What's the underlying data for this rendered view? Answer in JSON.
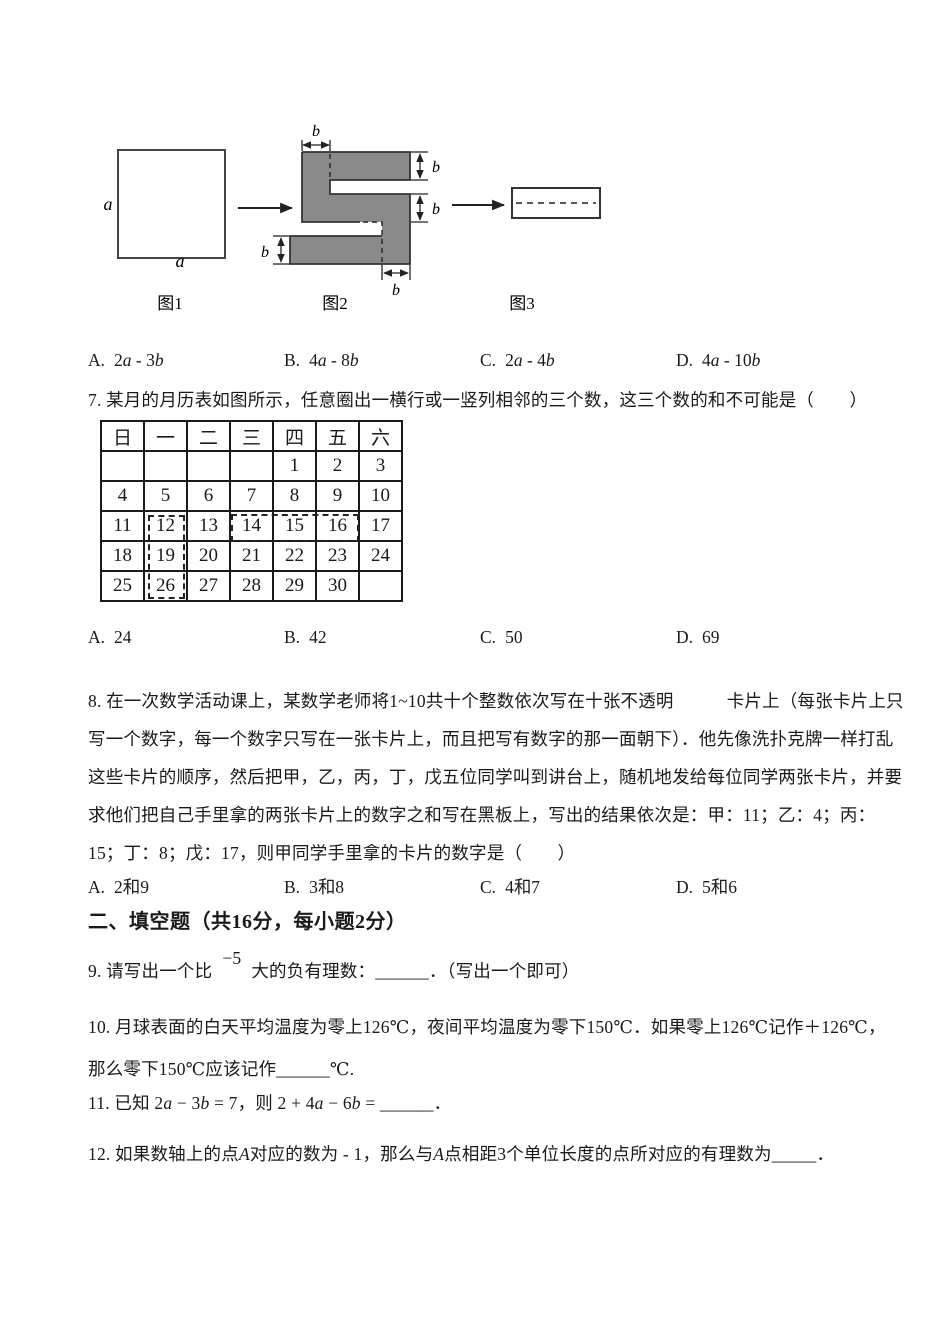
{
  "figure_row": {
    "fig1_caption": "图1",
    "fig2_caption": "图2",
    "fig3_caption": "图3",
    "side_label_a": "a",
    "dim_label_b": "b",
    "shape_fill": "#8a8a8a"
  },
  "q6_options": [
    {
      "key": "A.",
      "text": "2a - 3b"
    },
    {
      "key": "B.",
      "text": "4a - 8b"
    },
    {
      "key": "C.",
      "text": "2a - 4b"
    },
    {
      "key": "D.",
      "text": "4a - 10b"
    }
  ],
  "q7": {
    "text": "7. 某月的月历表如图所示，任意圈出一横行或一竖列相邻的三个数，这三个数的和不可能是（　　）",
    "options": [
      {
        "key": "A.",
        "text": "24"
      },
      {
        "key": "B.",
        "text": "42"
      },
      {
        "key": "C.",
        "text": "50"
      },
      {
        "key": "D.",
        "text": "69"
      }
    ]
  },
  "calendar": {
    "headers": [
      "日",
      "一",
      "二",
      "三",
      "四",
      "五",
      "六"
    ],
    "rows": [
      [
        "",
        "",
        "",
        "",
        "1",
        "2",
        "3"
      ],
      [
        "4",
        "5",
        "6",
        "7",
        "8",
        "9",
        "10"
      ],
      [
        "11",
        "12",
        "13",
        "14",
        "15",
        "16",
        "17"
      ],
      [
        "18",
        "19",
        "20",
        "21",
        "22",
        "23",
        "24"
      ],
      [
        "25",
        "26",
        "27",
        "28",
        "29",
        "30",
        ""
      ]
    ],
    "dashed_column_cells": [
      "12",
      "19",
      "26"
    ],
    "dashed_row_cells": [
      "14",
      "15",
      "16"
    ]
  },
  "q8": {
    "lines": [
      "8. 在一次数学活动课上，某数学老师将1~10共十个整数依次写在十张不透明　　　卡片上（每张卡片上只",
      "写一个数字，每一个数字只写在一张卡片上，而且把写有数字的那一面朝下）．他先像洗扑克牌一样打乱",
      "这些卡片的顺序，然后把甲，乙，丙，丁，戊五位同学叫到讲台上，随机地发给每位同学两张卡片，并要",
      "求他们把自己手里拿的两张卡片上的数字之和写在黑板上，写出的结果依次是：甲：11；乙：4；丙：",
      "15；丁：8；戊：17，则甲同学手里拿的卡片的数字是（　　）"
    ],
    "options": [
      {
        "key": "A.",
        "text": "2和9"
      },
      {
        "key": "B.",
        "text": "3和8"
      },
      {
        "key": "C.",
        "text": "4和7"
      },
      {
        "key": "D.",
        "text": "5和6"
      }
    ]
  },
  "section2_heading": "二、填空题（共16分，每小题2分）",
  "q9": {
    "prefix": "9. 请写出一个比",
    "raised": "−5",
    "suffix": "大的负有理数：______．（写出一个即可）"
  },
  "q10": {
    "line1": "10. 月球表面的白天平均温度为零上126℃，夜间平均温度为零下150℃．如果零上126℃记作＋126℃，",
    "line2": "那么零下150℃应该记作______℃."
  },
  "q11": {
    "text": "11. 已知 2a − 3b = 7，则 2 + 4a − 6b = ______．"
  },
  "q12": {
    "text": "12. 如果数轴上的点A对应的数为 - 1，那么与A点相距3个单位长度的点所对应的有理数为_____．"
  }
}
